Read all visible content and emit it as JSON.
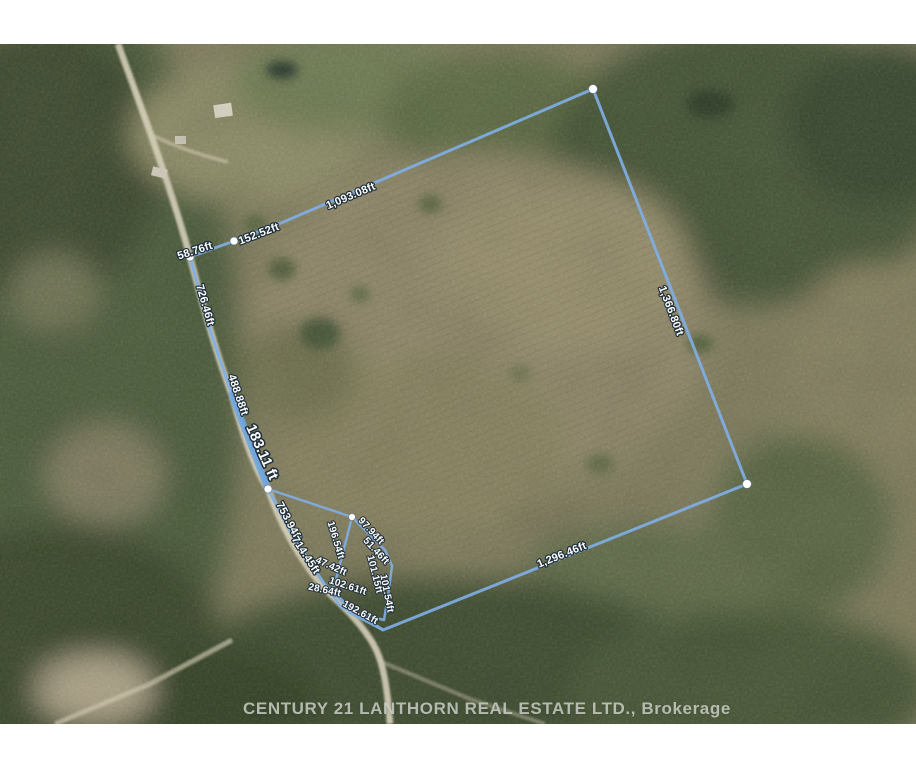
{
  "map": {
    "watermark": "CENTURY 21 LANTHORN REAL ESTATE LTD., Brokerage",
    "colors": {
      "boundary": "#7FAEE4",
      "boundary_bold": "#6BA3DF",
      "vertex": "#FFFFFF",
      "label_fill": "#FFFFFF",
      "label_halo": "#20303A",
      "watermark_text": "#D0D3CB"
    },
    "measurements": [
      {
        "name": "northwest-corner-segment",
        "label": "58.76ft"
      },
      {
        "name": "northwest-mid-segment",
        "label": "152.52ft"
      },
      {
        "name": "north-edge",
        "label": "1,093.08ft"
      },
      {
        "name": "east-edge",
        "label": "1,366.80ft"
      },
      {
        "name": "south-edge",
        "label": "1,296.46ft"
      },
      {
        "name": "west-road-upper",
        "label": "726.46ft"
      },
      {
        "name": "west-road-middle",
        "label": "488.88ft"
      },
      {
        "name": "west-road-highlighted",
        "label": "183.11 ft"
      },
      {
        "name": "west-road-lower-a",
        "label": "753.94ft"
      },
      {
        "name": "west-road-lower-b",
        "label": "714.45ft"
      },
      {
        "name": "inner-lot-west",
        "label": "196.54ft"
      },
      {
        "name": "inner-lot-northeast",
        "label": "97.94ft"
      },
      {
        "name": "inner-lot-east-upper",
        "label": "51.46ft"
      },
      {
        "name": "inner-lot-east-mid",
        "label": "101.15ft"
      },
      {
        "name": "inner-lot-east-lower",
        "label": "101.54ft"
      },
      {
        "name": "inner-lot-west-mid",
        "label": "47.42ft"
      },
      {
        "name": "inner-lot-south",
        "label": "102.61ft"
      },
      {
        "name": "inner-lot-southwest",
        "label": "28.64ft"
      },
      {
        "name": "inner-lot-outlet",
        "label": "192.61ft"
      }
    ]
  }
}
